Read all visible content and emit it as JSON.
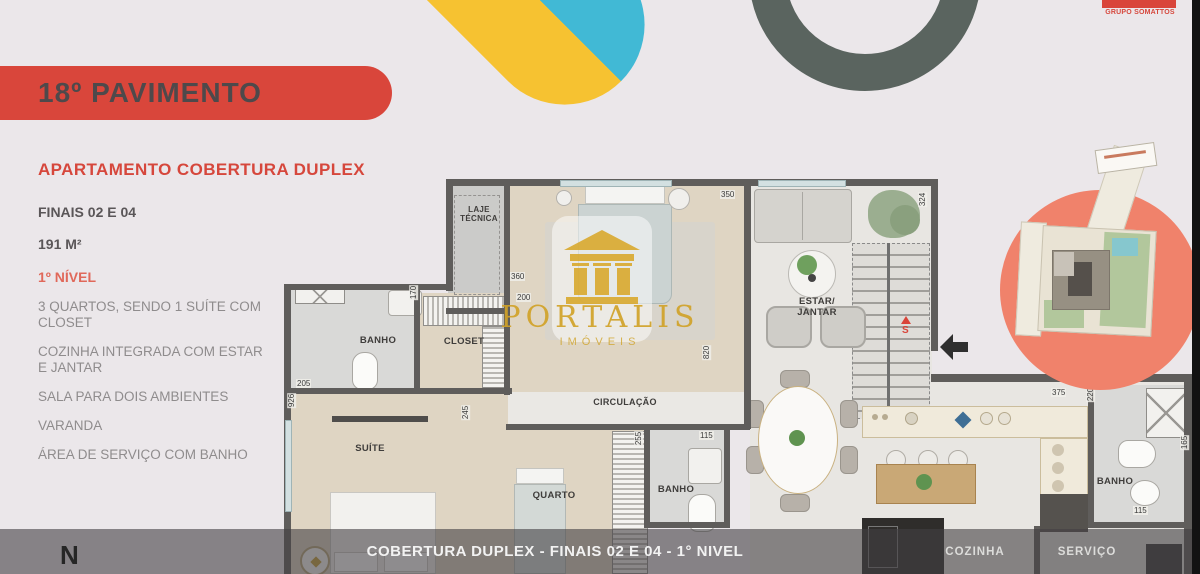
{
  "header": {
    "banner_title": "18º PAVIMENTO",
    "brand": "GRUPO SOMATTOS"
  },
  "info": {
    "title": "APARTAMENTO COBERTURA DUPLEX",
    "subtitle": "FINAIS 02 E 04",
    "area": "191 M²",
    "level": "1º NÍVEL",
    "features": [
      "3 QUARTOS, SENDO 1 SUÍTE COM CLOSET",
      "COZINHA INTEGRADA COM ESTAR E JANTAR",
      "SALA PARA DOIS AMBIENTES",
      "VARANDA",
      "ÁREA DE SERVIÇO COM BANHO"
    ]
  },
  "watermark": {
    "brand": "PORTALIS",
    "sub": "IMÓVEIS"
  },
  "plan": {
    "rooms": {
      "laje": "LAJE TÉCNICA",
      "banho_suite": "BANHO",
      "closet": "CLOSET",
      "suite": "SUÍTE",
      "quarto": "QUARTO",
      "circulacao": "CIRCULAÇÃO",
      "banho_meio": "BANHO",
      "estar": "ESTAR/ JANTAR",
      "banho_servico": "BANHO",
      "cozinha": "COZINHA",
      "servico": "SERVIÇO"
    },
    "dims": [
      "350",
      "324",
      "360",
      "200",
      "170",
      "205",
      "926",
      "245",
      "820",
      "255",
      "115",
      "375",
      "220",
      "115",
      "165"
    ],
    "stair_marker": "S",
    "compass": "N"
  },
  "footer": {
    "caption": "COBERTURA DUPLEX - FINAIS 02 E 04 - 1° NIVEL"
  },
  "colors": {
    "accent_red": "#D9453A",
    "salmon": "#F0826B",
    "yellow": "#F6C231",
    "teal": "#41B9D5",
    "ring_gray": "#5A645F",
    "gold": "#D0A228"
  }
}
